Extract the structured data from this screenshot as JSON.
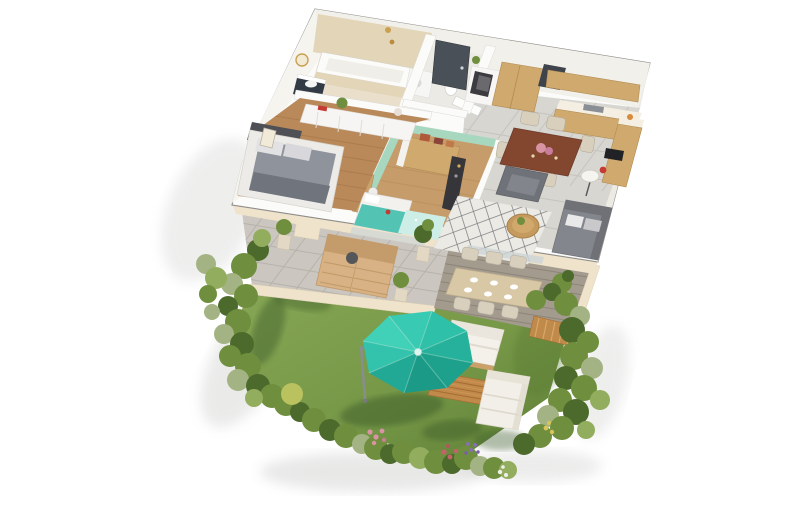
{
  "scene": {
    "type": "isometric-3d-floor-plan-render",
    "background": "#ffffff"
  },
  "colors": {
    "wall_top": "#fbfbfa",
    "wall_face": "#f2f0ea",
    "wall_outline": "#8e8c88",
    "outer_face_cream": "#efe3cc",
    "tile_floor": "#d8d6d1",
    "tile_line": "#c5c3be",
    "wood_floor": "#b9895a",
    "wood_floor_line": "#9e6f44",
    "wood_floor_2": "#c79c6b",
    "bath_tile": "#e3d5b8",
    "bath_floor": "#e9dfcb",
    "mint": "#a7d7bf",
    "teal": "#53c3b4",
    "teal_pale": "#cdeee6",
    "cabinet_wood": "#d0a96f",
    "table_dark": "#83462f",
    "chair_beige": "#d8d0bd",
    "door_dark": "#4a5058",
    "navy": "#323a46",
    "sofa_gray": "#84868d",
    "chair_gray": "#707279",
    "bed_gray": "#8f939b",
    "bed_throw": "#70747c",
    "bed_dark": "#4e5055",
    "frame_white": "#edebe7",
    "paver": "#cbc7c0",
    "paver_line": "#b7b2aa",
    "deck": "#a49b8f",
    "deck_line": "#8d8478",
    "wood_slat": "#c08a4a",
    "lawn": "#769847",
    "lawn_light": "#87a756",
    "lawn_dark": "#5a7a33",
    "lawn_shadow": "#3c5c29",
    "bush_mid": "#6f8f3e",
    "bush_dark": "#4c6a2c",
    "bush_light": "#93ad5e",
    "bush_gray": "#a4b383",
    "bush_yellow": "#b9c25e",
    "flower_pink": "#d894a4",
    "flower_red": "#c4626a",
    "flower_purple": "#8a6cc0",
    "flower_white": "#f0f0ea",
    "flower_yellow": "#d9c45a",
    "parasol_n": "#39cab3",
    "parasol_ne": "#2fc0a9",
    "parasol_e": "#25b19b",
    "parasol_se": "#1da18d",
    "parasol_s": "#1b9a88",
    "parasol_sw": "#22a995",
    "parasol_w": "#33c3ac",
    "parasol_nw": "#41d0b8",
    "parasol_hub": "#dff6f0",
    "pole_gray": "#8a8d90",
    "accent_red": "#c53a32",
    "wood_table": "#c59a5e",
    "outdoor_table": "#d9c8a6",
    "glass": "#cdd4d6",
    "shadow": "#9a9a96"
  },
  "objects": {
    "apartment": {
      "rooms": [
        {
          "name": "bathroom",
          "items": [
            "bathtub",
            "vanity",
            "round-mirror",
            "tiled-wall"
          ]
        },
        {
          "name": "wc",
          "items": [
            "toilet",
            "washing-machine"
          ]
        },
        {
          "name": "entry-hall",
          "items": [
            "front-door",
            "console-cabinet",
            "tall-wardrobe"
          ]
        },
        {
          "name": "kitchen",
          "items": [
            "wood-cabinets",
            "countertop",
            "sink",
            "cooktop",
            "dining-table",
            "dining-chairs"
          ]
        },
        {
          "name": "master-bedroom",
          "items": [
            "double-bed",
            "sideboard",
            "picture-frame"
          ]
        },
        {
          "name": "kids-bedroom",
          "items": [
            "wardrobe",
            "desk",
            "teal-bed",
            "teal-rug",
            "tv-unit"
          ]
        },
        {
          "name": "living-room",
          "items": [
            "corner-sofa",
            "armchair",
            "coffee-table",
            "diamond-rug",
            "floor-lamp"
          ]
        }
      ]
    },
    "outdoor": {
      "terrace": [
        "wood-loungers",
        "side-table",
        "potted-plants"
      ],
      "deck": [
        "outdoor-dining-table",
        "outdoor-chairs",
        "plates",
        "potted-plant",
        "slat-fence"
      ],
      "garden": [
        "lawn",
        "teal-parasol",
        "double-sun-lounger",
        "wood-platform",
        "garden-sofa",
        "bush-border",
        "flower-beds"
      ]
    }
  }
}
